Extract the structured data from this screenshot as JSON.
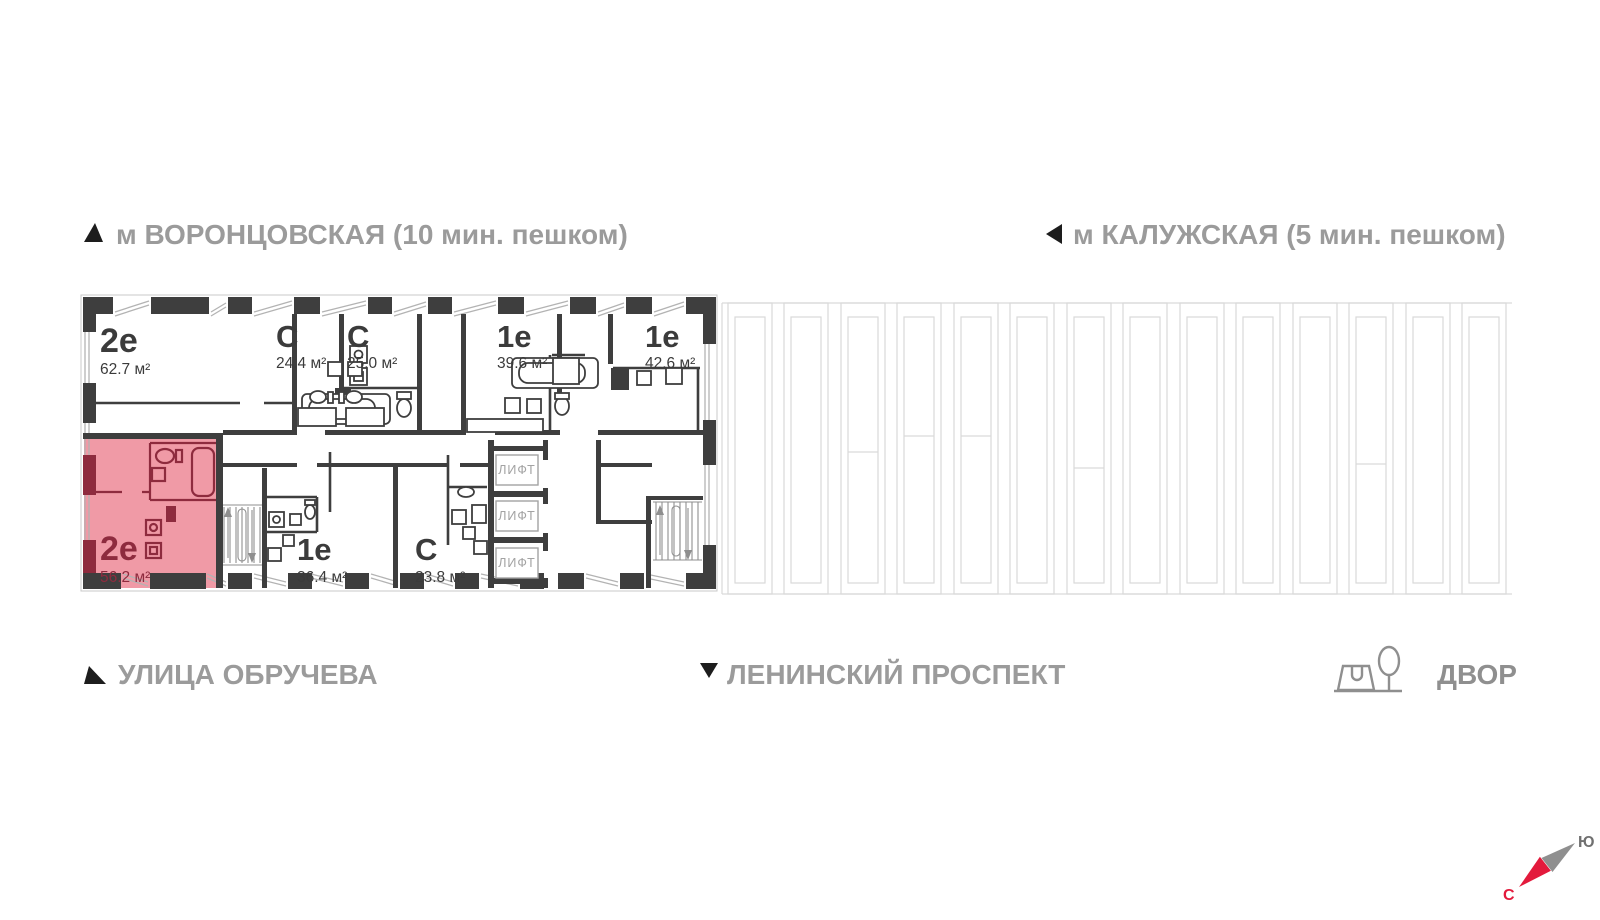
{
  "landmarks": {
    "metro_left": "м ВОРОНЦОВСКАЯ  (10 мин. пешком)",
    "metro_right": "м КАЛУЖСКАЯ (5 мин. пешком)",
    "street_left": "УЛИЦА ОБРУЧЕВА",
    "street_center": "ЛЕНИНСКИЙ ПРОСПЕКТ",
    "yard": "ДВОР"
  },
  "compass": {
    "north_label": "С",
    "south_label": "Ю",
    "north_color": "#e31a3c",
    "needle_gray": "#8f8f8f"
  },
  "plan": {
    "lift_label": "ЛИФТ",
    "wall_color": "#3e3e3e",
    "highlight_fill": "#f09aa6",
    "highlight_wall": "#8e2b3e",
    "apartments": [
      {
        "type": "2е",
        "area": "62.7 м²",
        "highlighted": false
      },
      {
        "type": "С",
        "area": "24.4 м²",
        "highlighted": false
      },
      {
        "type": "С",
        "area": "25.0 м²",
        "highlighted": false
      },
      {
        "type": "1е",
        "area": "39.6 м²",
        "highlighted": false
      },
      {
        "type": "1е",
        "area": "42.6 м²",
        "highlighted": false
      },
      {
        "type": "2е",
        "area": "56.2 м²",
        "highlighted": true
      },
      {
        "type": "1е",
        "area": "36.4 м²",
        "highlighted": false
      },
      {
        "type": "С",
        "area": "23.8 м²",
        "highlighted": false
      }
    ]
  }
}
